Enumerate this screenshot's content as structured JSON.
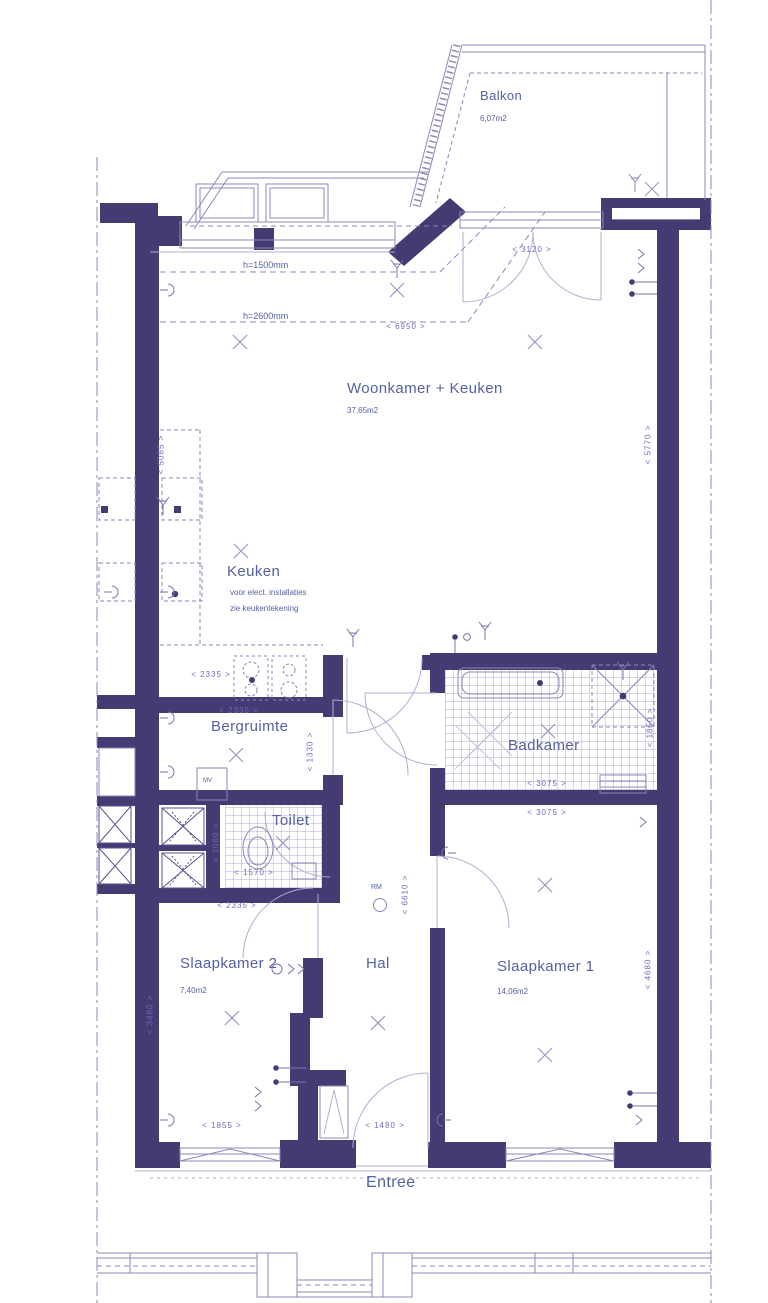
{
  "colors": {
    "wall": "#453a72",
    "line": "#8d87bb",
    "label": "#5560a4",
    "dim": "#7566c0"
  },
  "rooms": {
    "balkon": {
      "name": "Balkon",
      "area": "6,07m2"
    },
    "woonkamer": {
      "name": "Woonkamer + Keuken",
      "area": "37,65m2"
    },
    "keuken": {
      "name": "Keuken",
      "note1": "voor elect. installaties",
      "note2": "zie keukentekening"
    },
    "bergruimte": {
      "name": "Bergruimte"
    },
    "badkamer": {
      "name": "Badkamer"
    },
    "toilet": {
      "name": "Toilet"
    },
    "slaapkamer2": {
      "name": "Slaapkamer 2",
      "area": "7,40m2"
    },
    "hal": {
      "name": "Hal"
    },
    "slaapkamer1": {
      "name": "Slaapkamer 1",
      "area": "14,06m2"
    },
    "entree": {
      "name": "Entree"
    }
  },
  "annotations": {
    "h_window": "h=1500mm",
    "h_ceiling": "h=2600mm",
    "rm": "RM",
    "mv": "MV"
  },
  "dims": {
    "balcony_door_width": "< 3120 >",
    "living_width": "< 6950 >",
    "living_left_height": "< 5085 >",
    "living_right_height": "< 5770 >",
    "keuken_width": "< 2335 >",
    "bergruimte_width": "< 2335 >",
    "bergruimte_height": "< 1330 >",
    "badkamer_width": "< 3075 >",
    "badkamer_height": "< 1850 >",
    "slaapkamer1_width": "< 3075 >",
    "slaapkamer1_height": "< 4680 >",
    "toilet_width": "< 1570 >",
    "toilet_height": "< 1060 >",
    "slaapkamer2_width": "< 2335 >",
    "slaapkamer2_height": "< 3480 >",
    "slaapkamer2_window_width": "< 1855 >",
    "hal_height": "< 6610 >",
    "entree_door_width": "< 1480 >"
  }
}
